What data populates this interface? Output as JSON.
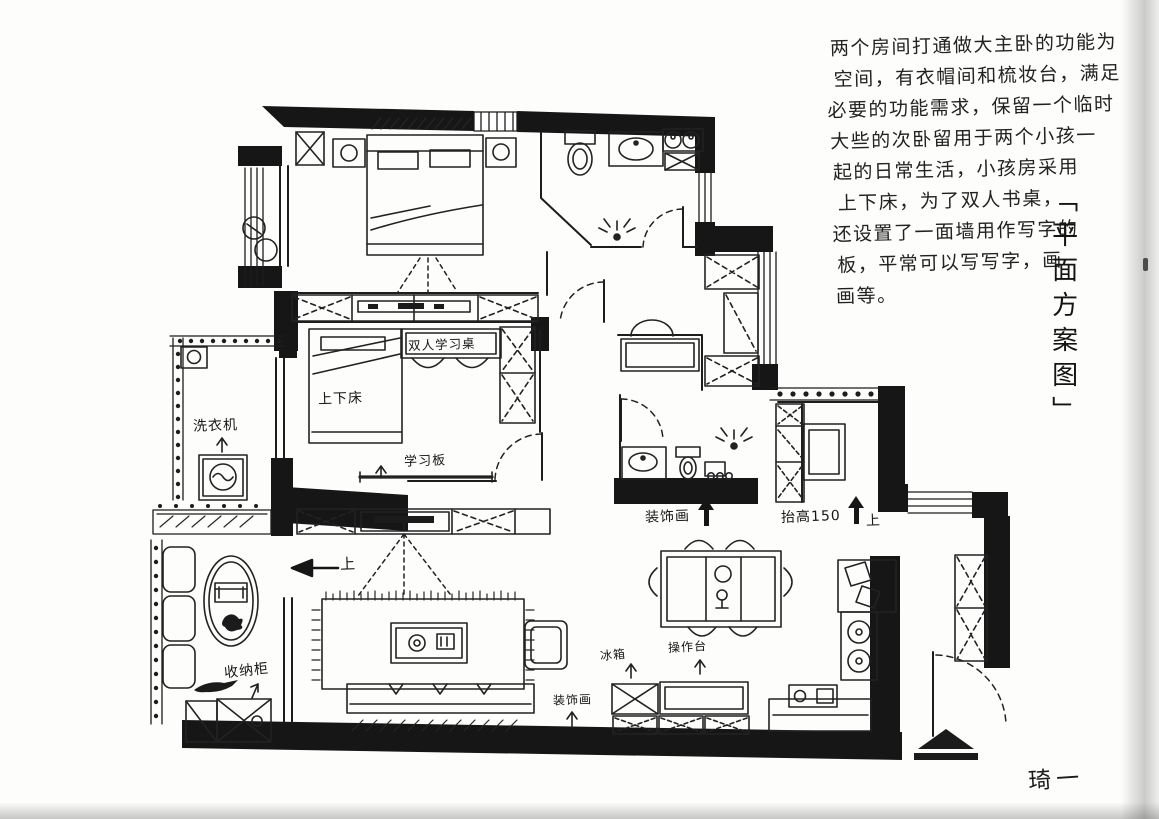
{
  "paper": {
    "background": "#fdfdfb",
    "ink": "#1d1d1d"
  },
  "annotation": {
    "lines": [
      "两个房间打通做大主卧的功能为",
      "空间，有衣帽间和梳妆台，满足",
      "必要的功能需求，保留一个临时",
      "大些的次卧留用于两个小孩一",
      "起的日常生活，小孩房采用",
      "上下床，为了双人书桌，",
      "还设置了一面墙用作写字的",
      "板，平常可以写写字，画",
      "画等。"
    ]
  },
  "side_title": {
    "bracket_open": "「",
    "text": "平面方案图",
    "bracket_close": "」"
  },
  "signature": {
    "text": "琦一"
  },
  "plan_labels": {
    "study_desk": "双人学习桌",
    "bunk_bed": "上下床",
    "study_board": "学习板",
    "washing_machine": "洗衣机",
    "storage_cabinet": "收纳柜",
    "deco_painting_hall": "装饰画",
    "raised_floor": "抬高150",
    "up_hall": "上",
    "up_balcony": "上",
    "deco_painting_living": "装饰画",
    "fridge": "冰箱",
    "counter": "操作台"
  }
}
